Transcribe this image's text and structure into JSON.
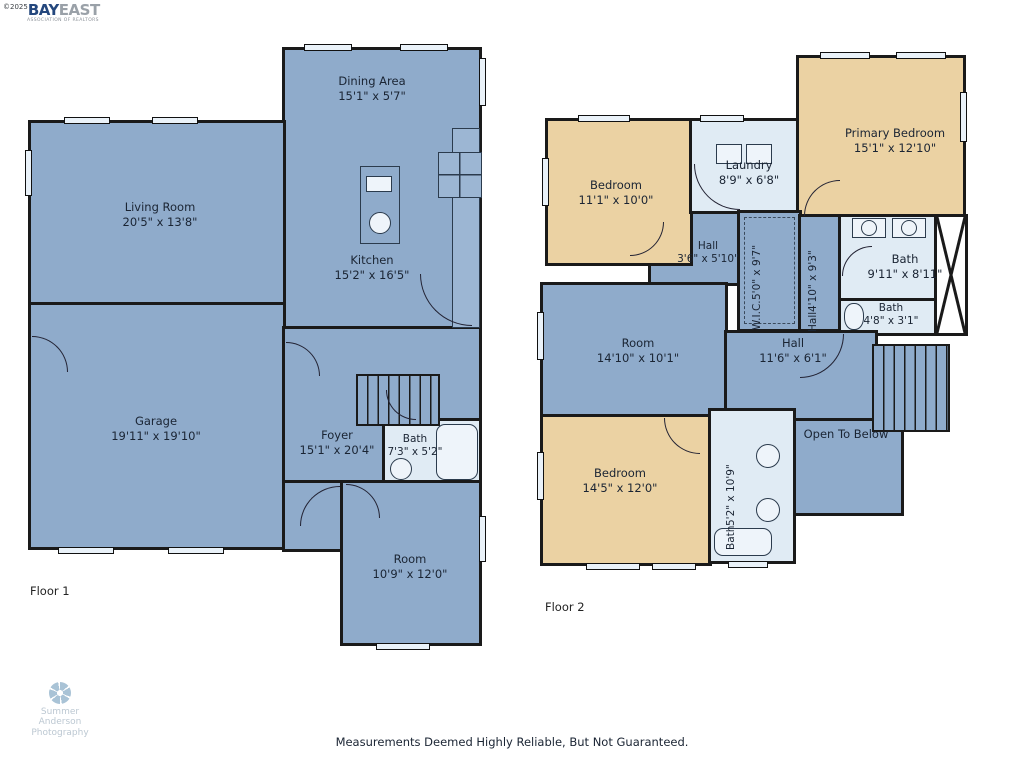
{
  "branding": {
    "copyright": "©2025",
    "name_primary": "BAY",
    "name_secondary": "EAST",
    "tagline": "ASSOCIATION OF REALTORS"
  },
  "watermark": {
    "line1": "Summer",
    "line2": "Anderson",
    "line3": "Photography"
  },
  "footer": {
    "disclaimer": "Measurements Deemed Highly Reliable, But Not Guaranteed."
  },
  "colors": {
    "room_blue": "#8FABCB",
    "room_tan": "#EBD2A3",
    "room_lightblue": "#E0EBF4",
    "wall": "#1a1a1a",
    "label_text": "#1a2433"
  },
  "floor1": {
    "label": "Floor 1",
    "rooms": {
      "dining": {
        "name": "Dining Area",
        "dims": "15'1\" x 5'7\""
      },
      "living": {
        "name": "Living Room",
        "dims": "20'5\" x 13'8\""
      },
      "kitchen": {
        "name": "Kitchen",
        "dims": "15'2\" x 16'5\""
      },
      "garage": {
        "name": "Garage",
        "dims": "19'11\" x 19'10\""
      },
      "foyer": {
        "name": "Foyer",
        "dims": "15'1\" x 20'4\""
      },
      "bath": {
        "name": "Bath",
        "dims": "7'3\" x 5'2\""
      },
      "room": {
        "name": "Room",
        "dims": "10'9\" x 12'0\""
      }
    }
  },
  "floor2": {
    "label": "Floor 2",
    "rooms": {
      "bedroom1": {
        "name": "Bedroom",
        "dims": "11'1\" x 10'0\""
      },
      "laundry": {
        "name": "Laundry",
        "dims": "8'9\" x 6'8\""
      },
      "primary": {
        "name": "Primary Bedroom",
        "dims": "15'1\" x 12'10\""
      },
      "hall_small": {
        "name": "Hall",
        "dims": "3'6\" x 5'10\""
      },
      "wic": {
        "name": "W.I.C.",
        "dims": "5'0\" x 9'7\""
      },
      "hall_vert": {
        "name": "Hall",
        "dims": "4'10\" x 9'3\""
      },
      "bath_big": {
        "name": "Bath",
        "dims": "9'11\" x 8'11\""
      },
      "bath_small": {
        "name": "Bath",
        "dims": "4'8\" x 3'1\""
      },
      "room": {
        "name": "Room",
        "dims": "14'10\" x 10'1\""
      },
      "hall_main": {
        "name": "Hall",
        "dims": "11'6\" x 6'1\""
      },
      "open_below": {
        "name": "Open To Below",
        "dims": ""
      },
      "bedroom2": {
        "name": "Bedroom",
        "dims": "14'5\" x 12'0\""
      },
      "bath_vert": {
        "name": "Bath",
        "dims": "5'2\" x 10'9\""
      }
    }
  }
}
